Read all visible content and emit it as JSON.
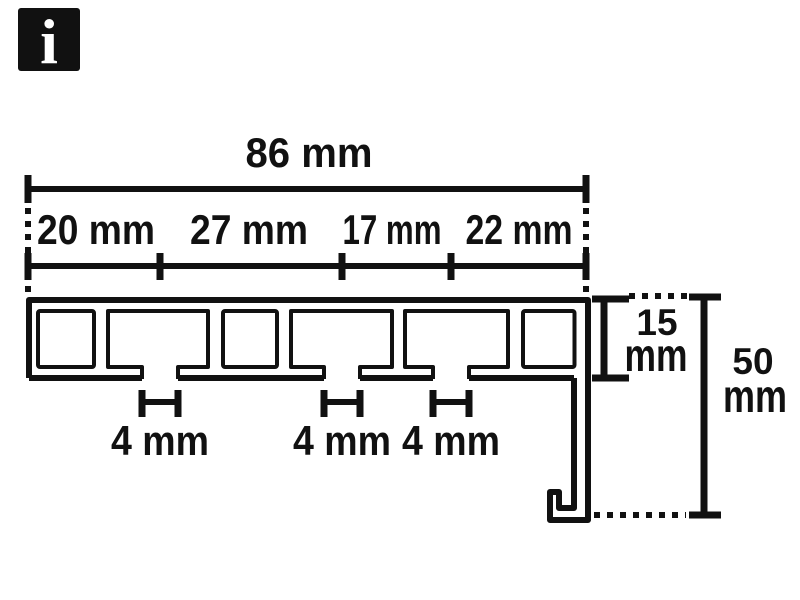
{
  "background": "#ffffff",
  "ink_color": "#111111",
  "info_badge": {
    "glyph": "i"
  },
  "dimensions": {
    "total_width": "86 mm",
    "segments": [
      "20 mm",
      "27 mm",
      "17 mm",
      "22 mm"
    ],
    "slots": [
      "4 mm",
      "4 mm",
      "4 mm"
    ],
    "profile_height": {
      "value": "15",
      "unit": "mm"
    },
    "total_height": {
      "value": "50",
      "unit": "mm"
    }
  }
}
